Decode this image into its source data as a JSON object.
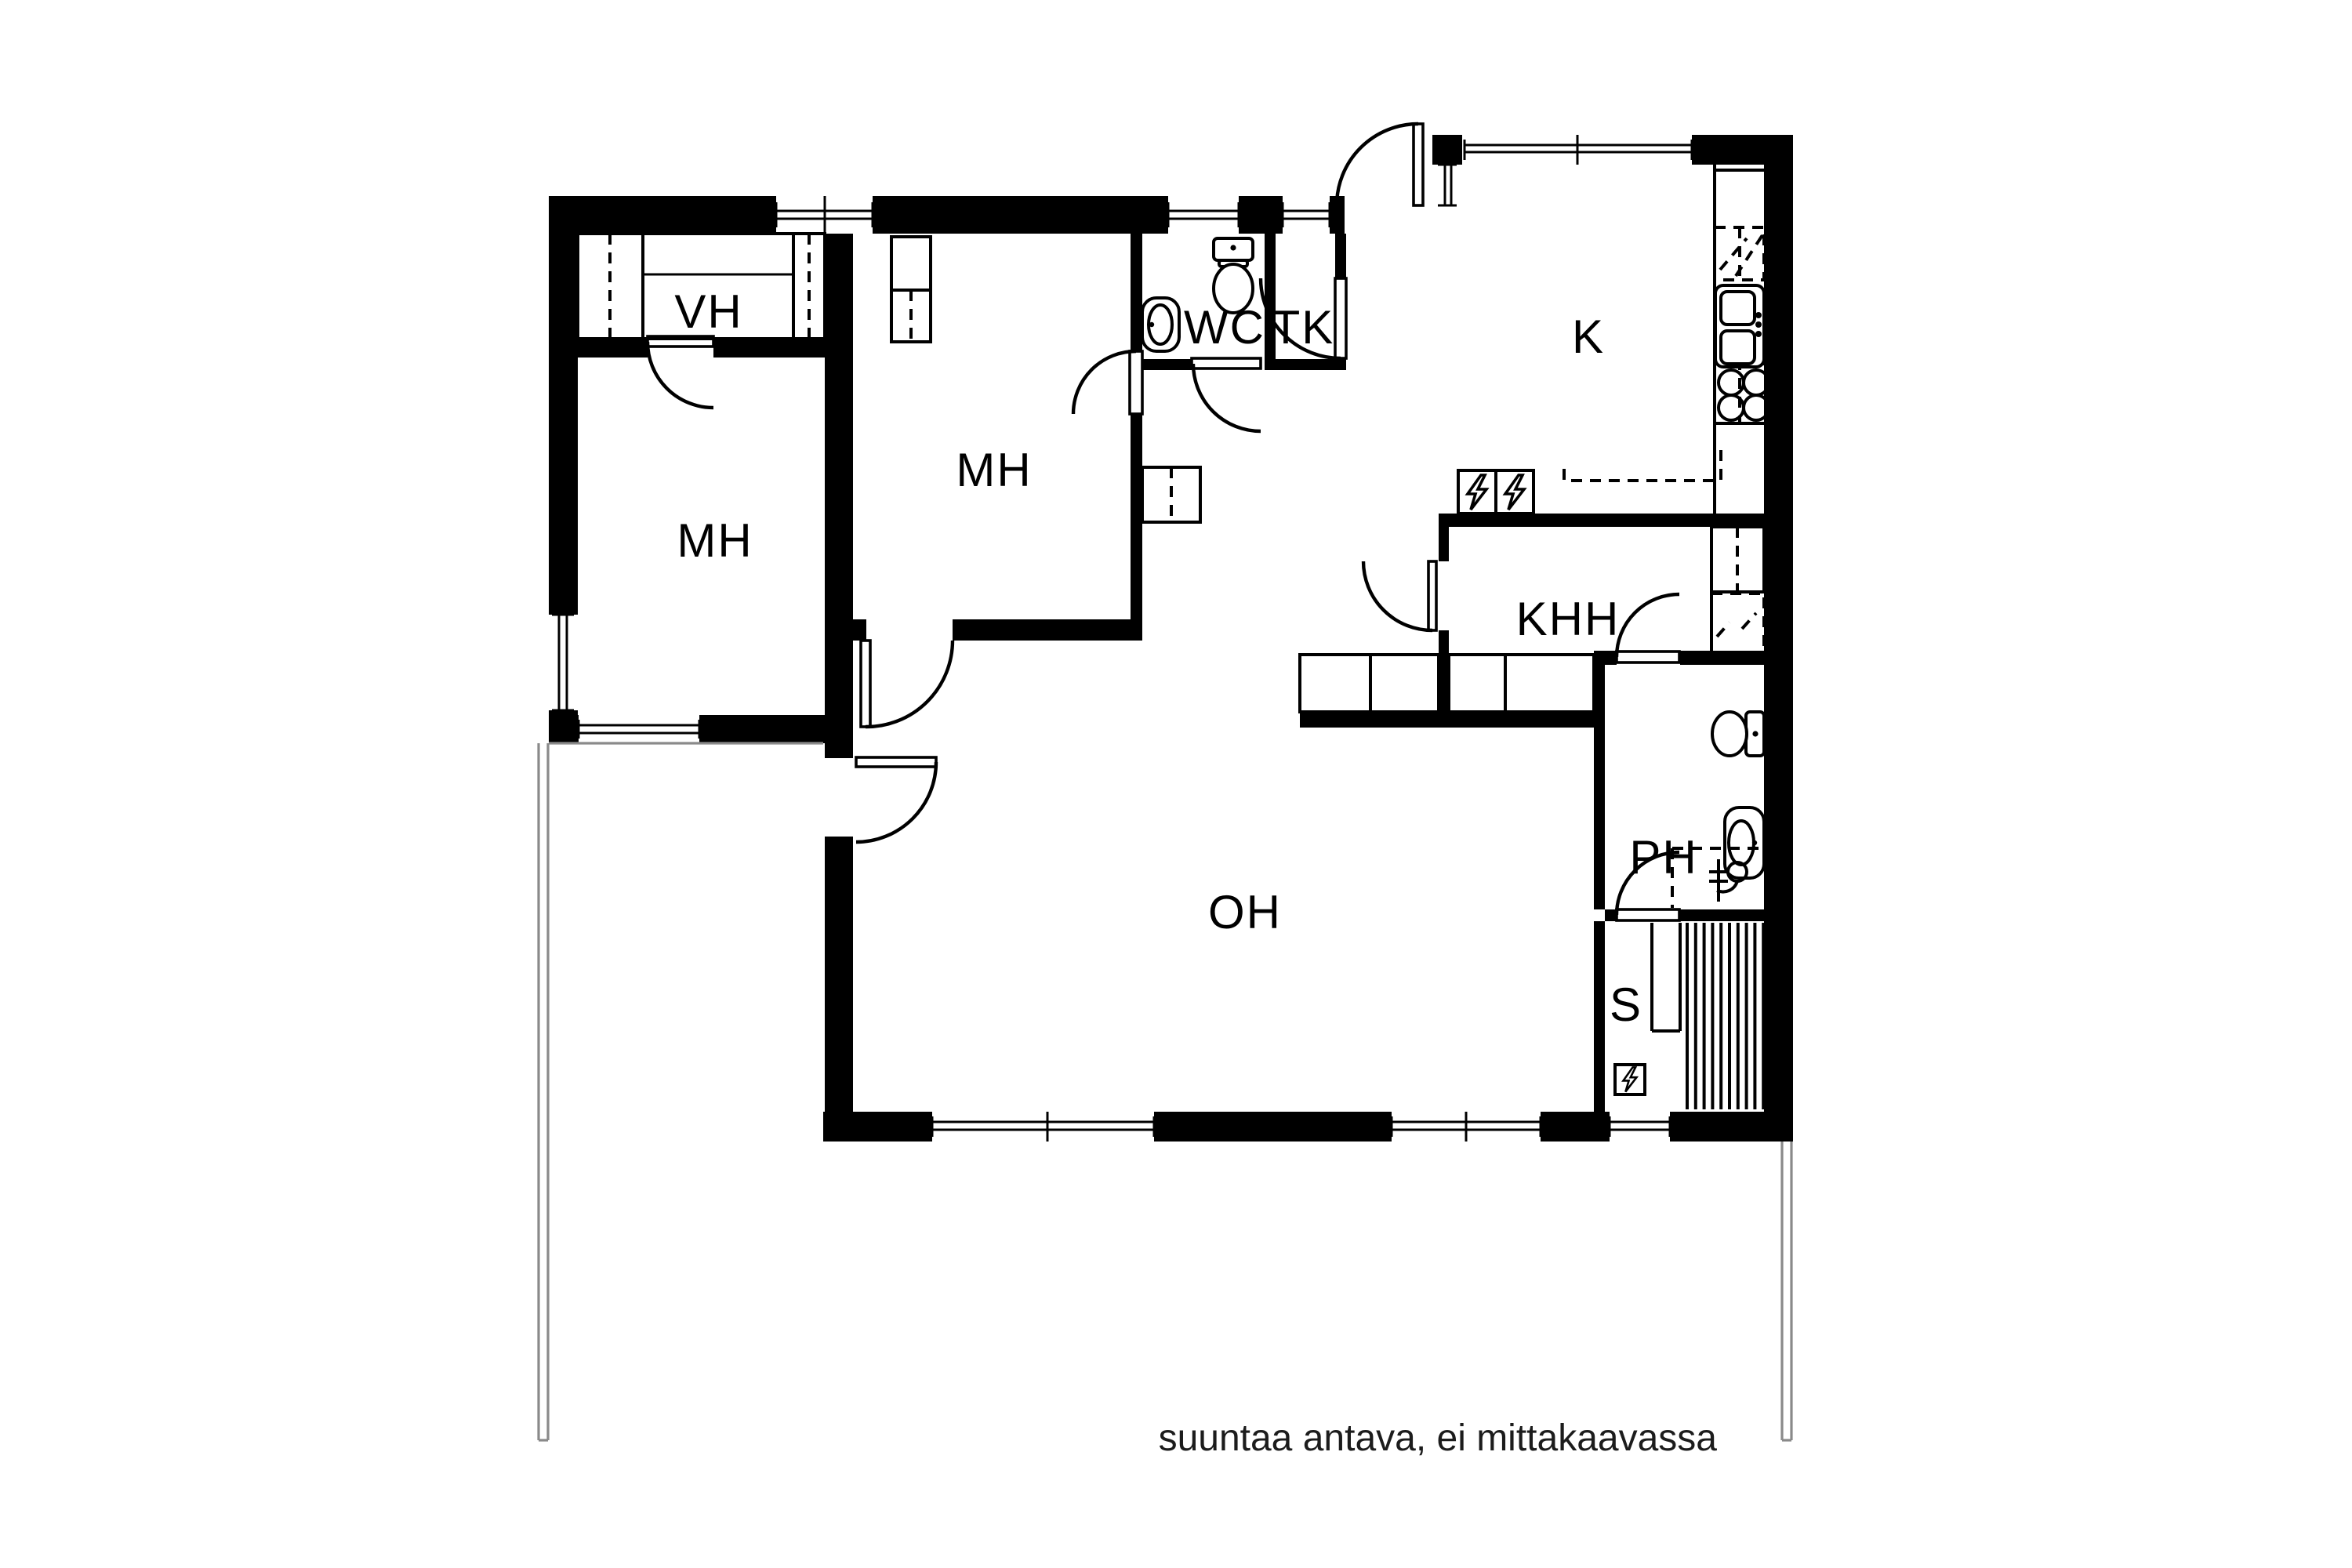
{
  "title": "floor-plan",
  "annotation": "suuntaa antava, ei mittakaavassa",
  "rooms": [
    {
      "id": "vh",
      "label": "VH"
    },
    {
      "id": "mh-left",
      "label": "MH"
    },
    {
      "id": "mh-right",
      "label": "MH"
    },
    {
      "id": "wc",
      "label": "WC"
    },
    {
      "id": "tk",
      "label": "TK"
    },
    {
      "id": "k",
      "label": "K"
    },
    {
      "id": "khh",
      "label": "KHH"
    },
    {
      "id": "ph",
      "label": "PH"
    },
    {
      "id": "oh",
      "label": "OH"
    },
    {
      "id": "s",
      "label": "S"
    }
  ],
  "colors": {
    "wall": "#000000",
    "background": "#ffffff",
    "terrace_line": "#8a8a8a"
  }
}
